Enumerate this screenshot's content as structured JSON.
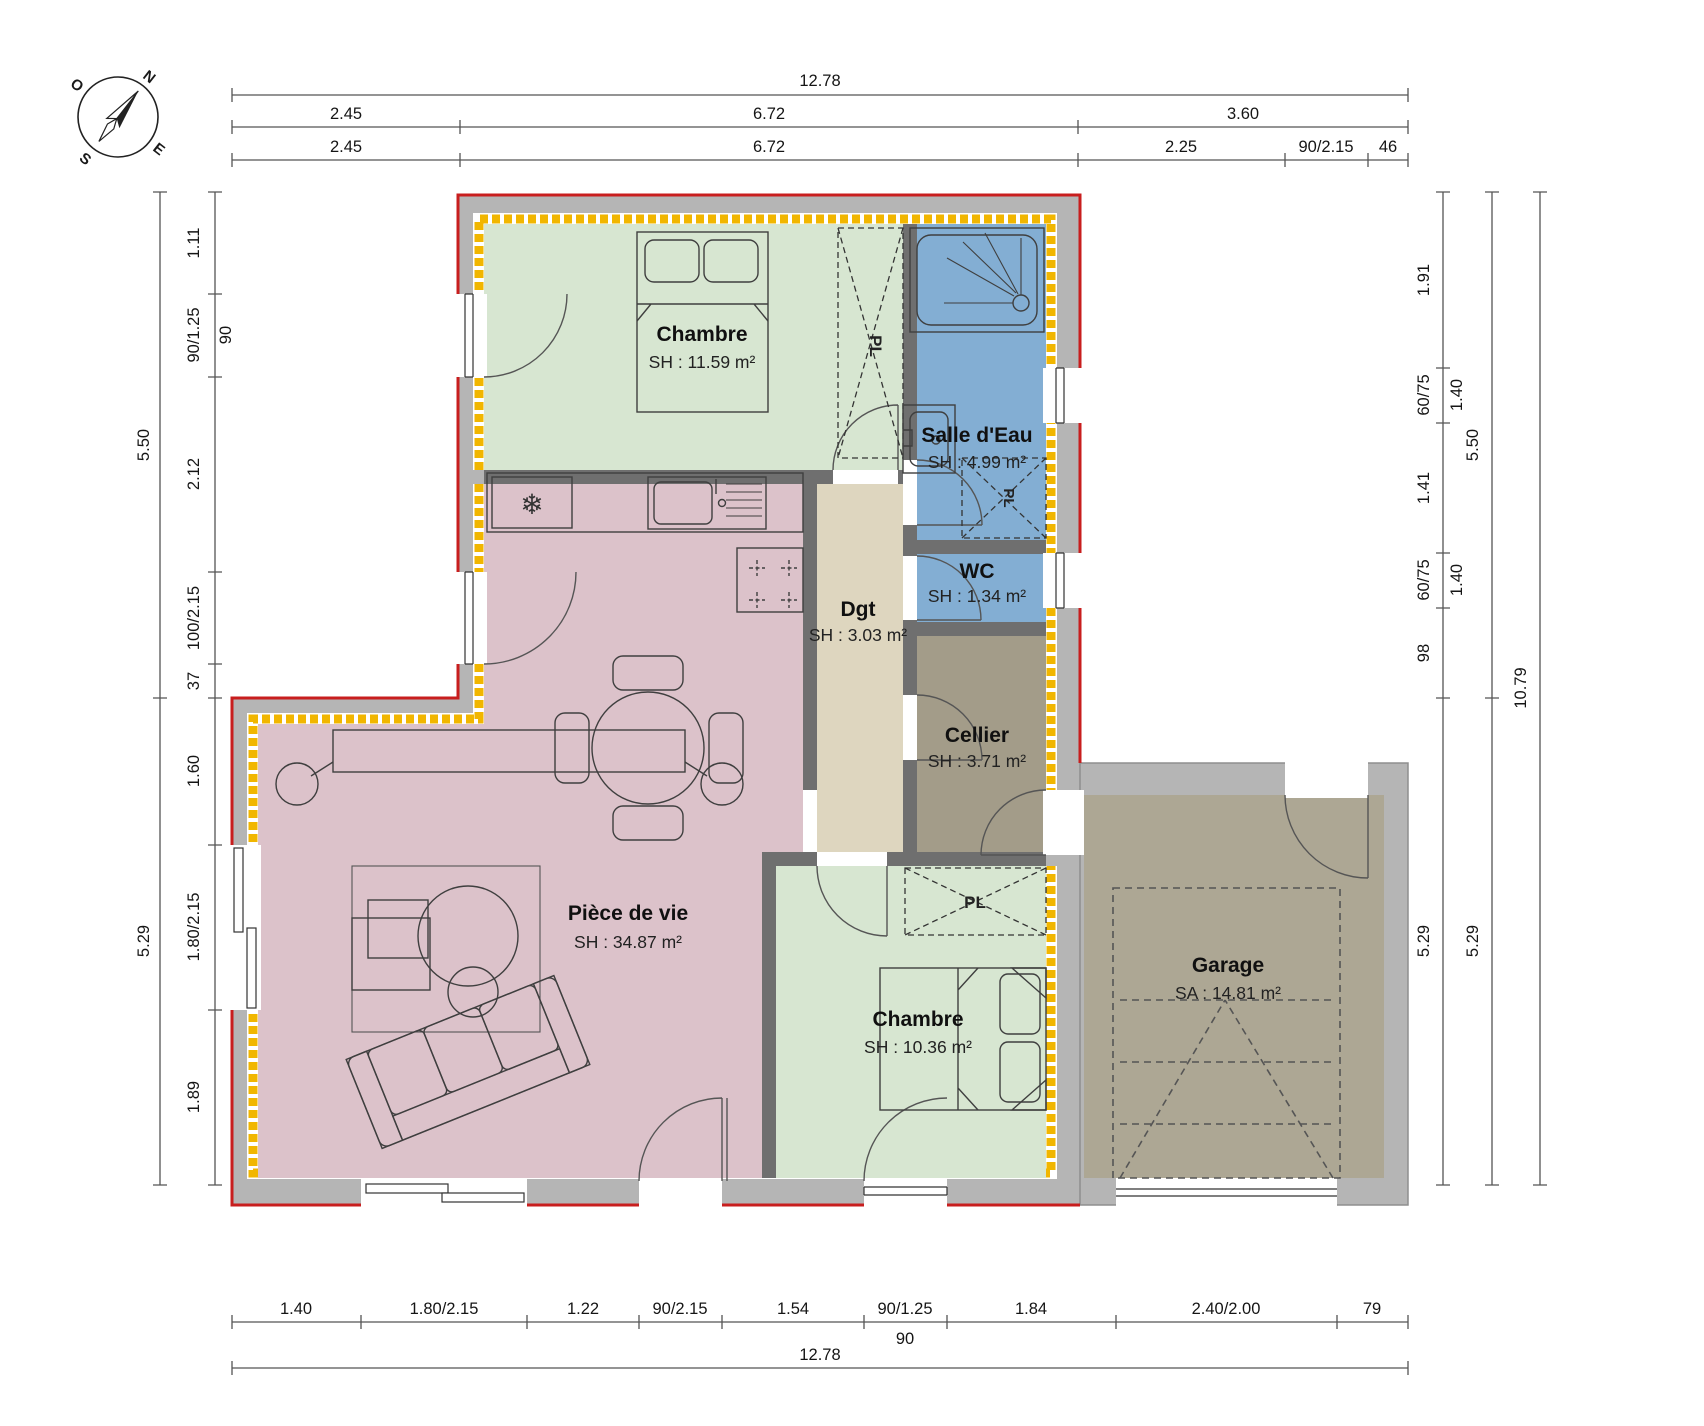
{
  "compass": {
    "north": "N",
    "east": "E",
    "south": "S",
    "west": "O"
  },
  "closet": {
    "label": "PL"
  },
  "icons": {
    "snowflake": "❄"
  },
  "rooms": {
    "chambre1": {
      "name": "Chambre",
      "area": "SH : 11.59 m²"
    },
    "salle_deau": {
      "name": "Salle d'Eau",
      "area": "SH : 4.99 m²"
    },
    "wc": {
      "name": "WC",
      "area": "SH : 1.34 m²"
    },
    "dgt": {
      "name": "Dgt",
      "area": "SH : 3.03 m²"
    },
    "cellier": {
      "name": "Cellier",
      "area": "SH : 3.71 m²"
    },
    "piece_de_vie": {
      "name": "Pièce de vie",
      "area": "SH : 34.87 m²"
    },
    "chambre2": {
      "name": "Chambre",
      "area": "SH : 10.36 m²"
    },
    "garage": {
      "name": "Garage",
      "area": "SA : 14.81 m²"
    }
  },
  "dims": {
    "top_total": "12.78",
    "top_row2": [
      "2.45",
      "6.72",
      "3.60"
    ],
    "top_row3": [
      "2.45",
      "6.72",
      "2.25",
      "90/2.15",
      "46"
    ],
    "left_outer": [
      "5.50",
      "5.29"
    ],
    "left_inner": [
      "1.11",
      "90/1.25",
      "90",
      "2.12",
      "100/2.15",
      "37",
      "1.60",
      "1.80/2.15",
      "1.89"
    ],
    "right_inner": [
      "1.91",
      "60/75",
      "1.40",
      "1.41",
      "60/75",
      "1.40",
      "98",
      "5.29"
    ],
    "right_mid": [
      "5.50",
      "5.29"
    ],
    "right_outer": "10.79",
    "bottom_row1": [
      "1.40",
      "1.80/2.15",
      "1.22",
      "90/2.15",
      "1.54",
      "90/1.25",
      "90",
      "1.84",
      "2.40/2.00",
      "79"
    ],
    "bottom_total": "12.78"
  },
  "colors": {
    "bedroom_green": "#d7e6d1",
    "bath_blue": "#83aed3",
    "living_pink": "#dcc2ca",
    "hall_beige": "#ded6bf",
    "cellar_taupe": "#a39c89",
    "garage_taupe": "#ada794",
    "wall_gray": "#b5b5b5",
    "partition_gray": "#6f6f6f",
    "insulation_yellow": "#f1b600",
    "envelope_red": "#c81e1e"
  }
}
